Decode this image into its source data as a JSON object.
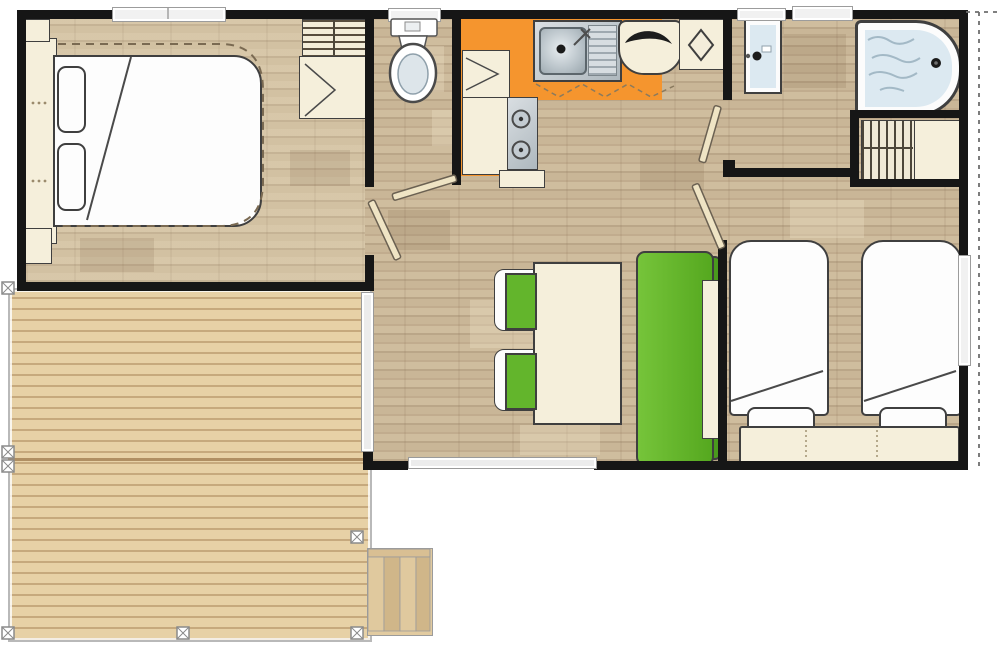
{
  "palette": {
    "wall": "#161616",
    "outline": "#3f3f3f",
    "floor": "#c9b697",
    "deck": "#e7d1a6",
    "orange": "#f5952e",
    "green": "#63b52c",
    "greenDark": "#4a9a1d",
    "cream": "#f5efdb",
    "creamDoor": "#efe4c4",
    "white": "#fdfdfd",
    "waterBlue": "#dce9f1",
    "steel": "#c6cdd2",
    "windowGray": "#f1f1f1",
    "dashBrown": "#7a6a52"
  }
}
